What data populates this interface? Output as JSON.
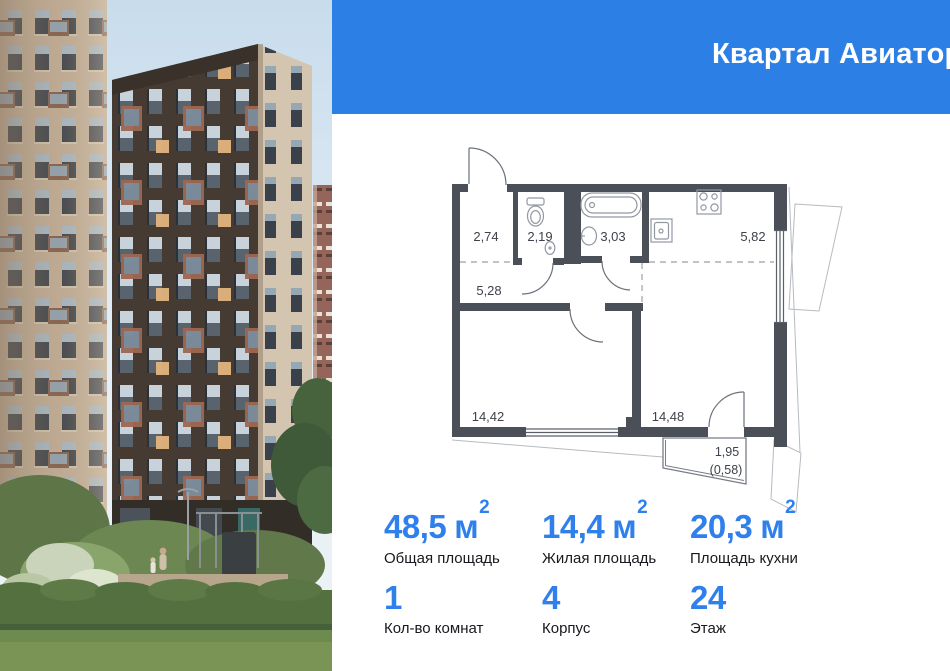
{
  "header": {
    "project_title": "Квартал Авиаторов",
    "brand_name": "самолет"
  },
  "floor_plan": {
    "rooms": [
      {
        "name": "entry",
        "area": "2,74"
      },
      {
        "name": "wc",
        "area": "2,19"
      },
      {
        "name": "bathroom",
        "area": "3,03"
      },
      {
        "name": "kitchen",
        "area": "5,82"
      },
      {
        "name": "hallway",
        "area": "5,28"
      },
      {
        "name": "living-room",
        "area": "14,42"
      },
      {
        "name": "kitchen-living",
        "area": "14,48"
      }
    ],
    "balcony": {
      "area": "1,95",
      "reduced_area": "(0,58)"
    }
  },
  "stats": {
    "areas": [
      {
        "value": "48,5",
        "unit": "м",
        "sup": "2",
        "label": "Общая площадь"
      },
      {
        "value": "14,4",
        "unit": "м",
        "sup": "2",
        "label": "Жилая площадь"
      },
      {
        "value": "20,3",
        "unit": "м",
        "sup": "2",
        "label": "Площадь кухни"
      }
    ],
    "details": [
      {
        "value": "1",
        "label": "Кол-во комнат"
      },
      {
        "value": "4",
        "label": "Корпус"
      },
      {
        "value": "24",
        "label": "Этаж"
      }
    ]
  },
  "colors": {
    "header_bg": "#2c7fe4",
    "accent": "#2f80ed",
    "plan_wall": "#4b5058"
  }
}
